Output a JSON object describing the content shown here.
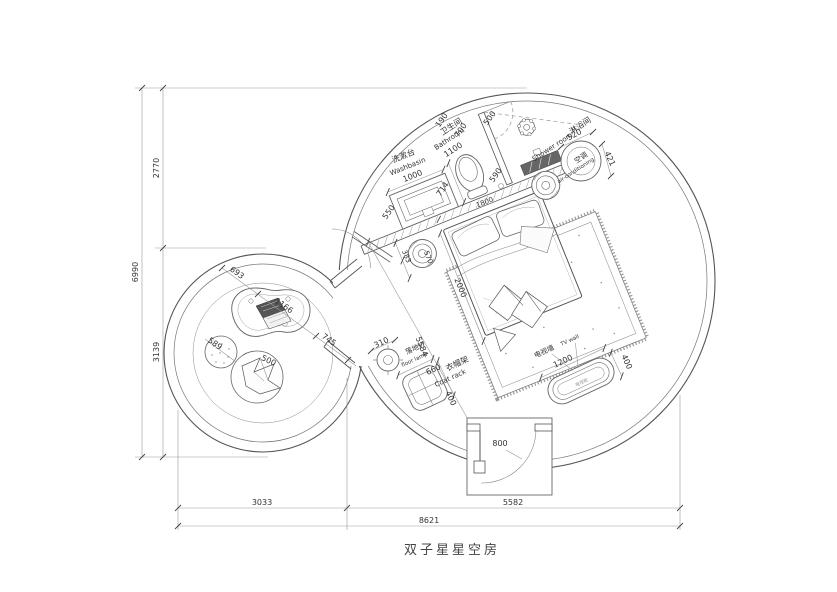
{
  "title": "双子星星空房",
  "labels": {
    "washbasin_zh": "洗漱台",
    "washbasin_en": "Washbasin",
    "bathroom_zh": "卫生间",
    "bathroom_en": "Bathroom",
    "shower_zh": "淋浴间",
    "shower_en": "Shower room",
    "ac_zh": "空调",
    "ac_en": "air-conditioning",
    "floor_lamp_zh": "落地灯",
    "floor_lamp_en": "floor lamp",
    "coat_rack_zh": "衣帽架",
    "coat_rack_en": "Coat rack",
    "tv_wall_zh": "电视墙",
    "tv_wall_en": "TV wall",
    "tv_cabinet_zh": "电视柜"
  },
  "dims": {
    "overall_height": "6990",
    "height_top": "2770",
    "height_bottom": "3139",
    "bottom_seg1": "3033",
    "bottom_seg2": "5582",
    "overall_width": "8621",
    "washbasin_w": "1000",
    "washbasin_d": "550",
    "bathroom_w": "1100",
    "d190": "190",
    "d700": "700",
    "door_bath": "500",
    "d590": "590",
    "d714": "714",
    "bed_w": "1800",
    "bed_l": "2000",
    "room_diag": "5584",
    "d383": "383",
    "d570": "570",
    "d520": "520",
    "d421": "421",
    "lamp_d": "310",
    "coat_w": "660",
    "coat_d": "400",
    "tv_w": "1200",
    "tv_d": "400",
    "door_main": "800",
    "desk_seg1": "693",
    "desk_seg2": "1166",
    "desk_seg3": "745",
    "stool_d": "589",
    "chair_d": "500"
  }
}
